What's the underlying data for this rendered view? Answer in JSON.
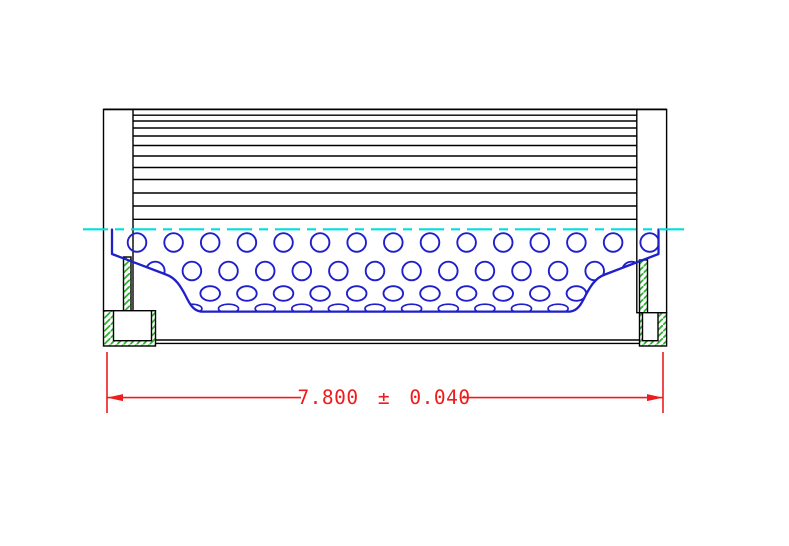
{
  "drawing": {
    "type": "technical-cross-section",
    "subject": "filter element side section view",
    "dimension": {
      "label": "7.800 ± 0.040",
      "value": "7.800",
      "plus_minus": "±",
      "tolerance": "0.040"
    },
    "parts": [
      {
        "name": "pleated-media",
        "rendering": "stacked horizontal lines"
      },
      {
        "name": "left-end-cap",
        "rendering": "sectioned, green hatch"
      },
      {
        "name": "right-end-cap",
        "rendering": "sectioned, green hatch"
      },
      {
        "name": "perforated-core-tube",
        "rendering": "blue hole pattern"
      },
      {
        "name": "centerline",
        "rendering": "cyan dashed"
      },
      {
        "name": "length-dimension",
        "rendering": "red extension lines and arrows"
      }
    ],
    "colors": {
      "outline": "#000000",
      "core_blue": "#1f1fcb",
      "centerline_cyan": "#00dede",
      "hatch_green": "#2db32d",
      "dimension_red": "#ee1c1c",
      "background": "#ffffff"
    }
  }
}
